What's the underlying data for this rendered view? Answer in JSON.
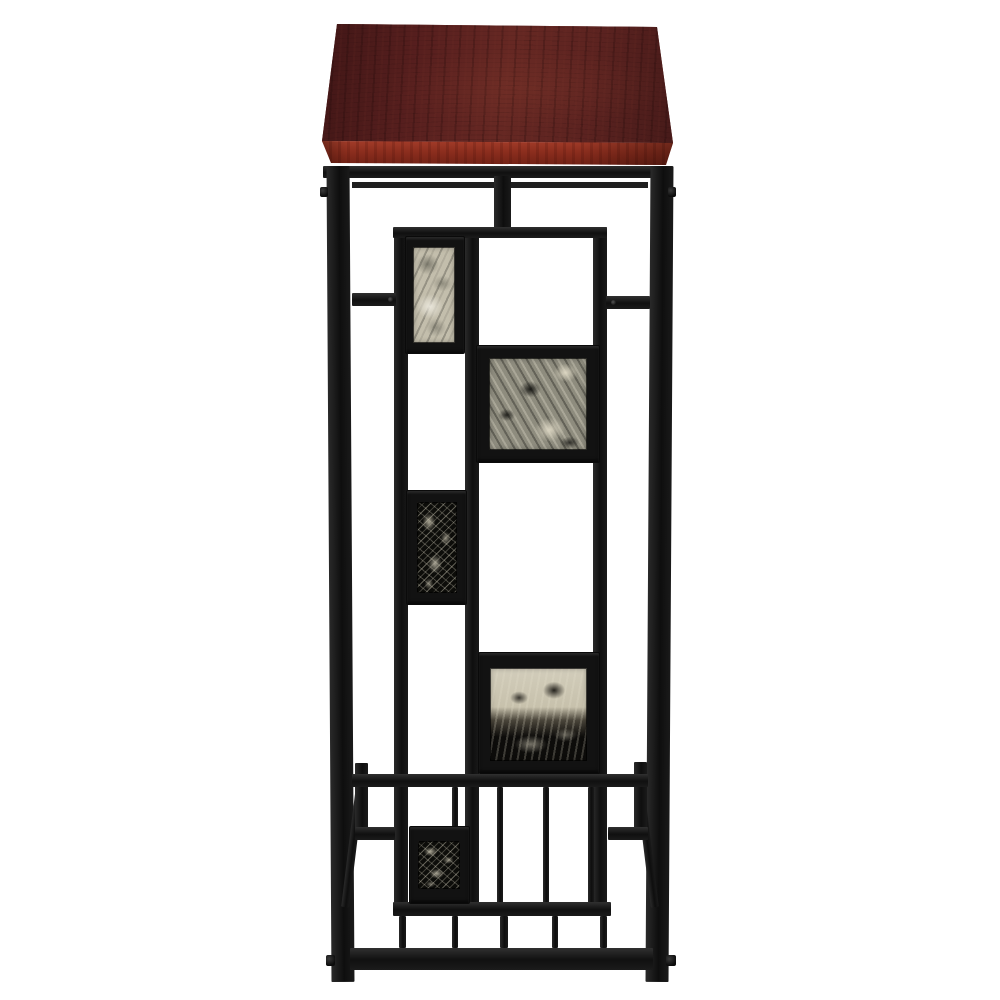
{
  "image": {
    "type": "product-photo",
    "subject": "Accent side table, front view",
    "alt": "Black metal accent table with dark cherry wood top, geometric frame inset with five faux-marble tiles, and a lower slatted shelf, photographed on a white background",
    "background_color": "#ffffff"
  },
  "palette": {
    "wood_shadow": "#431a19",
    "wood_base": "#5e2421",
    "wood_highlight": "#682823",
    "wood_edge_light": "#a63e2b",
    "wood_edge_dark": "#6e2014",
    "metal_base": "#141414",
    "metal_highlight": "#2e2e2e",
    "marble_cream": "#c3beac",
    "marble_gray": "#8e8c7e",
    "marble_black": "#0d0d0a",
    "marble_vein": "#d9d3bf"
  },
  "parts": {
    "top": "rectangular cherry-finish wood top",
    "frame": "black square-tube metal frame",
    "panel": "inner geometric tile panel",
    "tiles": [
      "light marble portrait tile",
      "gray-black marble square tile",
      "black marble portrait tile with cream veins",
      "cream-over-black marble square tile",
      "black marble portrait tile"
    ],
    "shelf": "lower shelf with vertical slats",
    "stretcher": "bottom front stretcher bar"
  }
}
